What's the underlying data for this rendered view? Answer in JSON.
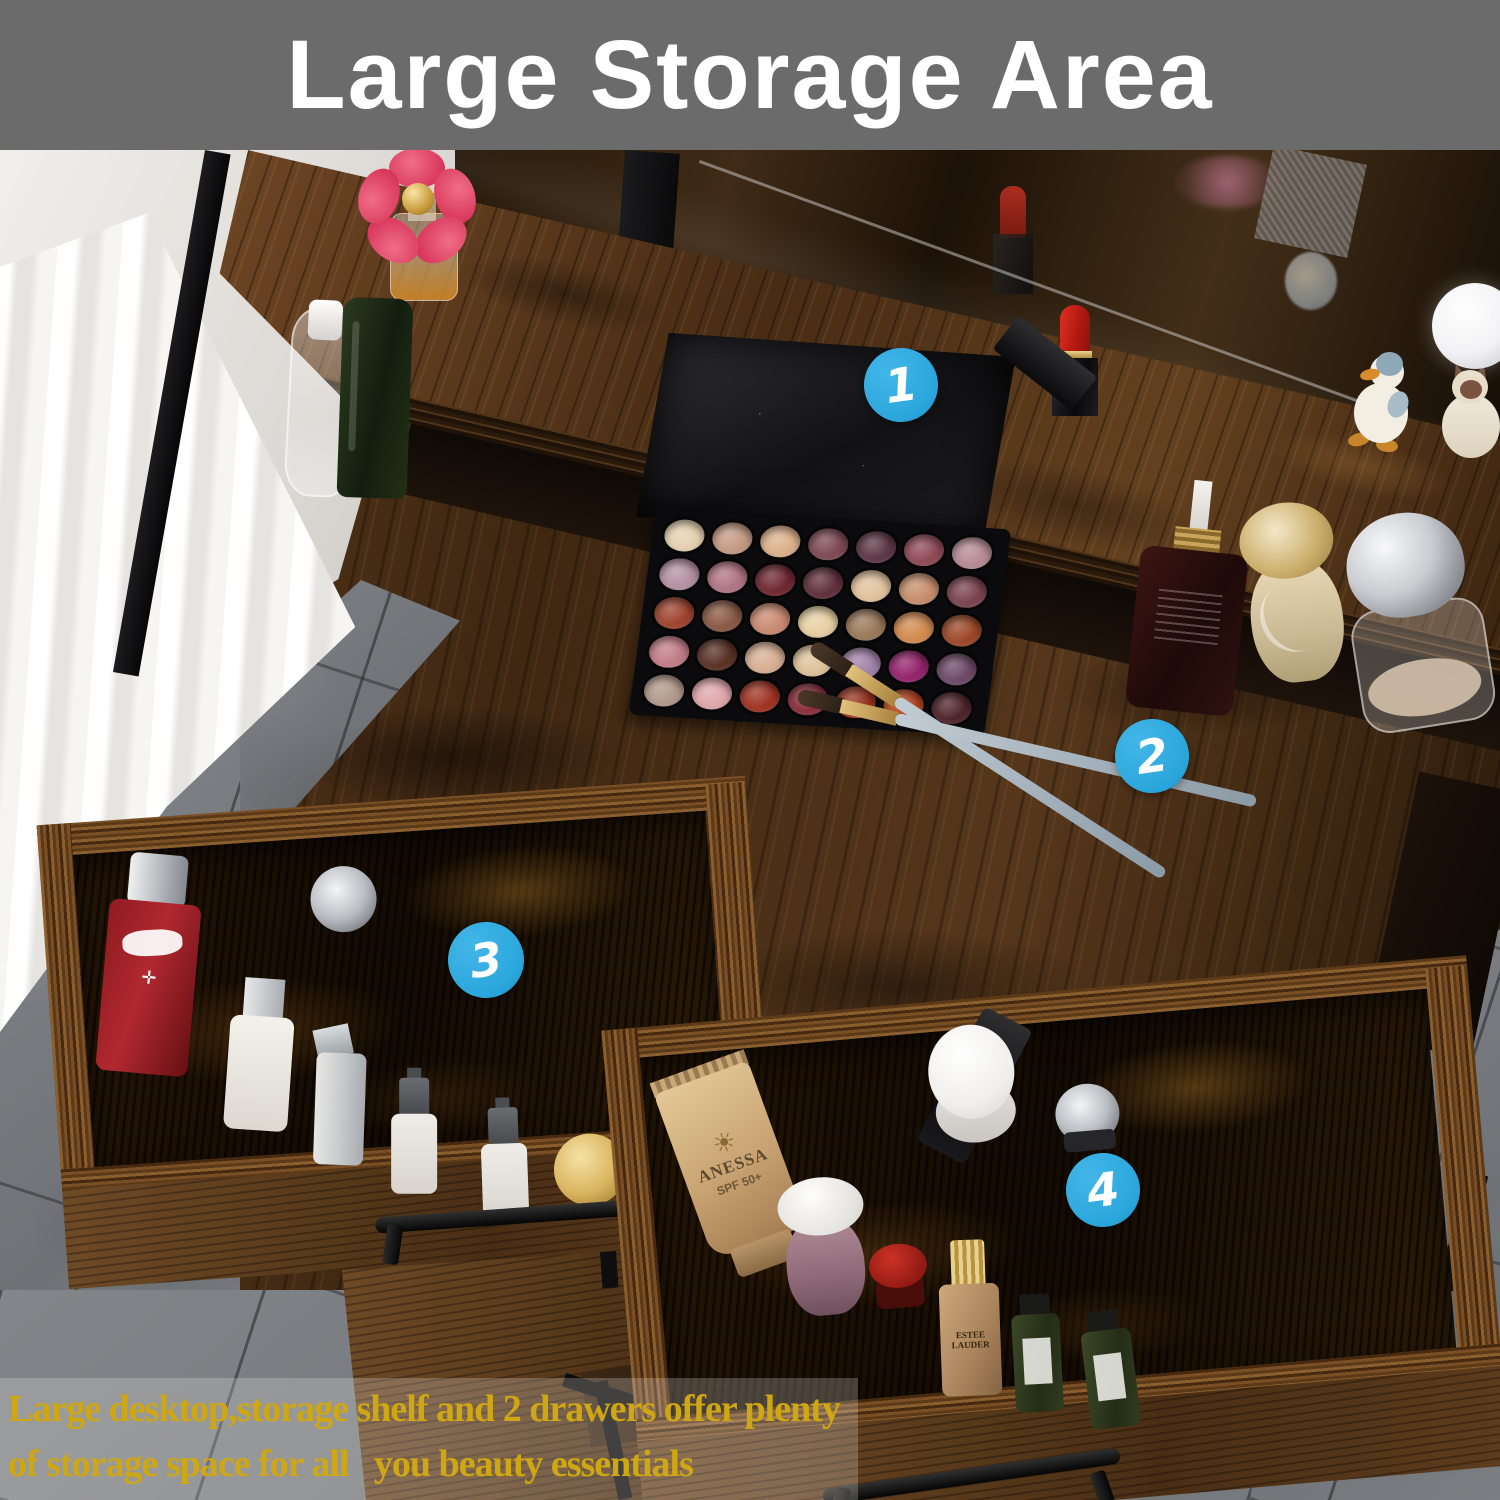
{
  "banner": {
    "title": "Large Storage Area",
    "bg_color": "#6b6b6b",
    "text_color": "#ffffff"
  },
  "markers": {
    "accent_color": "#2aa6dc",
    "items": [
      {
        "label": "1",
        "points_to": "storage-shelf"
      },
      {
        "label": "2",
        "points_to": "desktop"
      },
      {
        "label": "3",
        "points_to": "left-drawer"
      },
      {
        "label": "4",
        "points_to": "right-drawer"
      }
    ]
  },
  "caption": {
    "text_color": "#cfa712",
    "line1": "Large desktop,storage shelf and 2 drawers offer plenty",
    "line2": "of storage space for all   you beauty essentials"
  },
  "products": {
    "sunscreen_brand": "ANESSA",
    "sunscreen_spf": "SPF 50+",
    "sunscreen_sun_icon": "☀",
    "foundation_brand": "ESTEE LAUDER"
  },
  "palette": {
    "rows": 5,
    "cols": 7,
    "pan_colors": [
      "#e6d2b2",
      "#c59a84",
      "#dcb28c",
      "#7e4a54",
      "#5e3846",
      "#904a58",
      "#b78b98",
      "#b592a4",
      "#b27686",
      "#702832",
      "#60303e",
      "#e2c39e",
      "#c78f6d",
      "#7a4450",
      "#9e4430",
      "#8a5a46",
      "#ca8a72",
      "#e9d0a4",
      "#9a7a5a",
      "#d28c50",
      "#9c4828",
      "#c27e88",
      "#5a3226",
      "#d8b094",
      "#dfc29c",
      "#a383ab",
      "#96246e",
      "#6e4a68",
      "#b29a8c",
      "#e0a8ac",
      "#a03424",
      "#8c303e",
      "#98331f",
      "#b5461f",
      "#50242c"
    ]
  }
}
